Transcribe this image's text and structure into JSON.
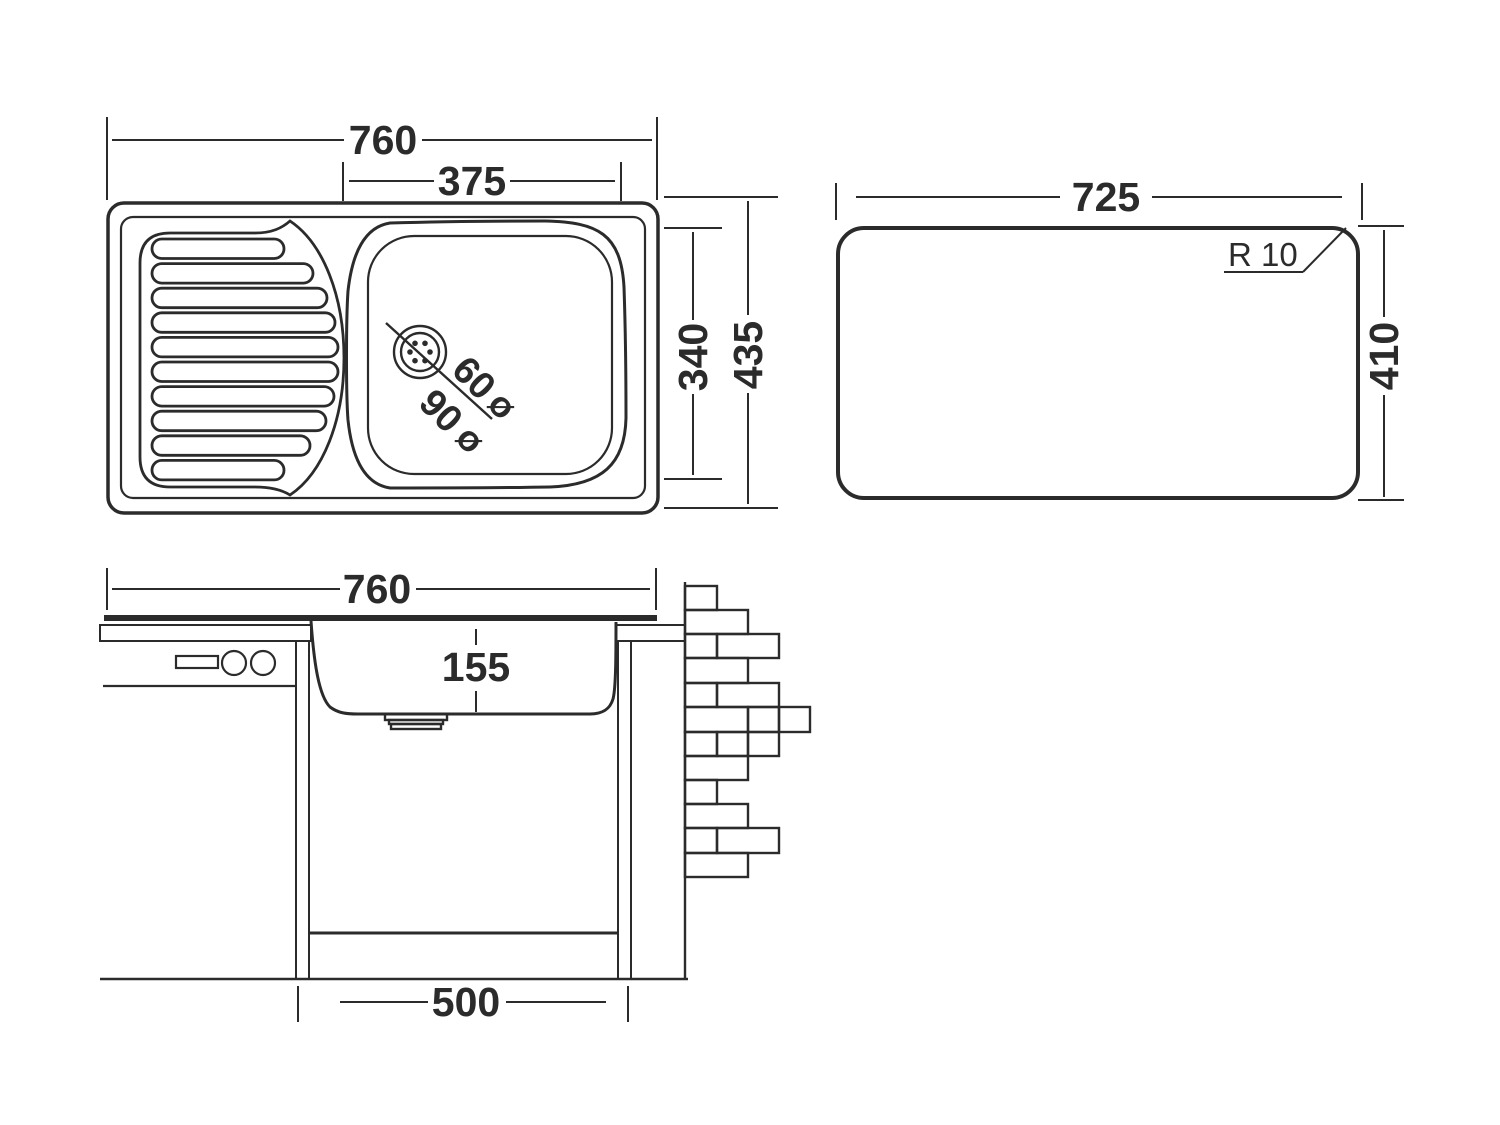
{
  "drawing": {
    "title": "kitchen-sink-dimension-drawing",
    "background_color": "#ffffff",
    "line_color": "#2b2b2b"
  },
  "top_view": {
    "total_width": "760",
    "bowl_width": "375",
    "bowl_depth": "340",
    "total_depth": "435",
    "drain_hole_diameter": "60",
    "drain_flange_diameter": "90",
    "diameter_symbol": "Ø"
  },
  "cutout_view": {
    "cutout_width": "725",
    "cutout_depth": "410",
    "corner_radius": "R 10"
  },
  "section_view": {
    "total_width": "760",
    "bowl_depth": "155",
    "cabinet_width": "500"
  }
}
